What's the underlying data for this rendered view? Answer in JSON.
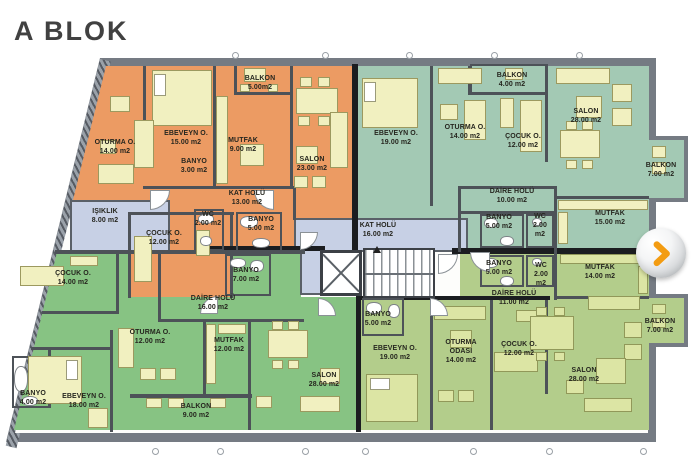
{
  "title": "A BLOK",
  "palette": {
    "apartment_orange": "#EC9B63",
    "apartment_sage": "#A3C9B4",
    "apartment_green": "#87C383",
    "apartment_yellow_green": "#B3CD8B",
    "hall_blue": "#C7D0E5",
    "furniture_pale": "#F1F0C0",
    "furniture_olive": "#DCE5A4",
    "wall_inner": "#4D5258",
    "wall_outer": "#757B83",
    "button_arrow_orange": "#F39C12",
    "title_color": "#414141"
  },
  "icons": {
    "nav_next": "chevron-right-icon"
  },
  "rooms": [
    {
      "zone": "orange",
      "label": "OTURMA O.",
      "area": "14.00 m2",
      "x": 115,
      "y": 143
    },
    {
      "zone": "orange",
      "label": "EBEVEYN O.",
      "area": "15.00 m2",
      "x": 186,
      "y": 134
    },
    {
      "zone": "orange",
      "label": "BANYO",
      "area": "3.00 m2",
      "x": 194,
      "y": 162,
      "w": 34
    },
    {
      "zone": "orange",
      "label": "MUTFAK",
      "area": "9.00 m2",
      "x": 243,
      "y": 141,
      "w": 40
    },
    {
      "zone": "orange",
      "label": "BALKON",
      "area": "5.00m2",
      "x": 260,
      "y": 79
    },
    {
      "zone": "orange",
      "label": "SALON",
      "area": "23.00 m2",
      "x": 312,
      "y": 160
    },
    {
      "zone": "orange",
      "label": "KAT HOLÜ",
      "area": "13.00 m2",
      "x": 247,
      "y": 194
    },
    {
      "zone": "orange",
      "label": "ÇOCUK O.",
      "area": "12.00 m2",
      "x": 164,
      "y": 234
    },
    {
      "zone": "orange",
      "label": "WC",
      "area": "2.00 m2",
      "x": 208,
      "y": 215,
      "w": 28
    },
    {
      "zone": "orange",
      "label": "BANYO",
      "area": "5.00 m2",
      "x": 261,
      "y": 220,
      "w": 36
    },
    {
      "zone": "common",
      "label": "IŞIKLIK",
      "area": "8.00 m2",
      "x": 105,
      "y": 212
    },
    {
      "zone": "common",
      "label": "KAT HOLÜ",
      "area": "16.00 m2",
      "x": 378,
      "y": 226
    },
    {
      "zone": "sage",
      "label": "EBEVEYN O.",
      "area": "19.00 m2",
      "x": 396,
      "y": 134
    },
    {
      "zone": "sage",
      "label": "OTURMA O.",
      "area": "14.00 m2",
      "x": 465,
      "y": 128
    },
    {
      "zone": "sage",
      "label": "BALKON",
      "area": "4.00 m2",
      "x": 512,
      "y": 76
    },
    {
      "zone": "sage",
      "label": "ÇOCUK O.",
      "area": "12.00 m2",
      "x": 523,
      "y": 137
    },
    {
      "zone": "sage",
      "label": "SALON",
      "area": "28.00 m2",
      "x": 586,
      "y": 112
    },
    {
      "zone": "sage",
      "label": "BALKON",
      "area": "7.00 m2",
      "x": 661,
      "y": 166,
      "w": 34
    },
    {
      "zone": "sage",
      "label": "MUTFAK",
      "area": "15.00 m2",
      "x": 610,
      "y": 214,
      "w": 40
    },
    {
      "zone": "sage",
      "label": "DAİRE HOLÜ",
      "area": "10.00 m2",
      "x": 512,
      "y": 192
    },
    {
      "zone": "sage",
      "label": "BANYO",
      "area": "5.00 m2",
      "x": 499,
      "y": 218,
      "w": 36
    },
    {
      "zone": "sage",
      "label": "WC",
      "area": "2.00 m2",
      "x": 540,
      "y": 217,
      "w": 26
    },
    {
      "zone": "green",
      "label": "ÇOCUK O.",
      "area": "14.00 m2",
      "x": 73,
      "y": 274
    },
    {
      "zone": "green",
      "label": "BANYO",
      "area": "7.00 m2",
      "x": 246,
      "y": 271,
      "w": 36
    },
    {
      "zone": "green",
      "label": "DAİRE HOLÜ",
      "area": "16.00 m2",
      "x": 213,
      "y": 299
    },
    {
      "zone": "green",
      "label": "OTURMA O.",
      "area": "12.00 m2",
      "x": 150,
      "y": 333
    },
    {
      "zone": "green",
      "label": "MUTFAK",
      "area": "12.00 m2",
      "x": 229,
      "y": 341,
      "w": 40
    },
    {
      "zone": "green",
      "label": "SALON",
      "area": "28.00 m2",
      "x": 324,
      "y": 376
    },
    {
      "zone": "green",
      "label": "EBEVEYN O.",
      "area": "18.00 m2",
      "x": 84,
      "y": 397
    },
    {
      "zone": "green",
      "label": "BANYO",
      "area": "4.00 m2",
      "x": 33,
      "y": 394,
      "w": 34
    },
    {
      "zone": "green",
      "label": "BALKON",
      "area": "9.00 m2",
      "x": 196,
      "y": 407
    },
    {
      "zone": "yellow-green",
      "label": "BANYO",
      "area": "5.00 m2",
      "x": 499,
      "y": 264,
      "w": 36
    },
    {
      "zone": "yellow-green",
      "label": "WC",
      "area": "2.00 m2",
      "x": 541,
      "y": 266,
      "w": 26
    },
    {
      "zone": "yellow-green",
      "label": "MUTFAK",
      "area": "14.00 m2",
      "x": 600,
      "y": 268,
      "w": 40
    },
    {
      "zone": "yellow-green",
      "label": "DAİRE HOLÜ",
      "area": "11.00 m2",
      "x": 514,
      "y": 294
    },
    {
      "zone": "yellow-green",
      "label": "BANYO",
      "area": "5.00 m2",
      "x": 378,
      "y": 315,
      "w": 36
    },
    {
      "zone": "yellow-green",
      "label": "EBEVEYN O.",
      "area": "19.00 m2",
      "x": 395,
      "y": 349
    },
    {
      "zone": "yellow-green",
      "label": "OTURMA ODASI",
      "area": "14.00 m2",
      "x": 461,
      "y": 343,
      "w": 42
    },
    {
      "zone": "yellow-green",
      "label": "ÇOCUK O.",
      "area": "12.00 m2",
      "x": 519,
      "y": 345
    },
    {
      "zone": "yellow-green",
      "label": "SALON",
      "area": "28.00 m2",
      "x": 584,
      "y": 371
    },
    {
      "zone": "yellow-green",
      "label": "BALKON",
      "area": "7.00 m2",
      "x": 660,
      "y": 322,
      "w": 34
    }
  ]
}
